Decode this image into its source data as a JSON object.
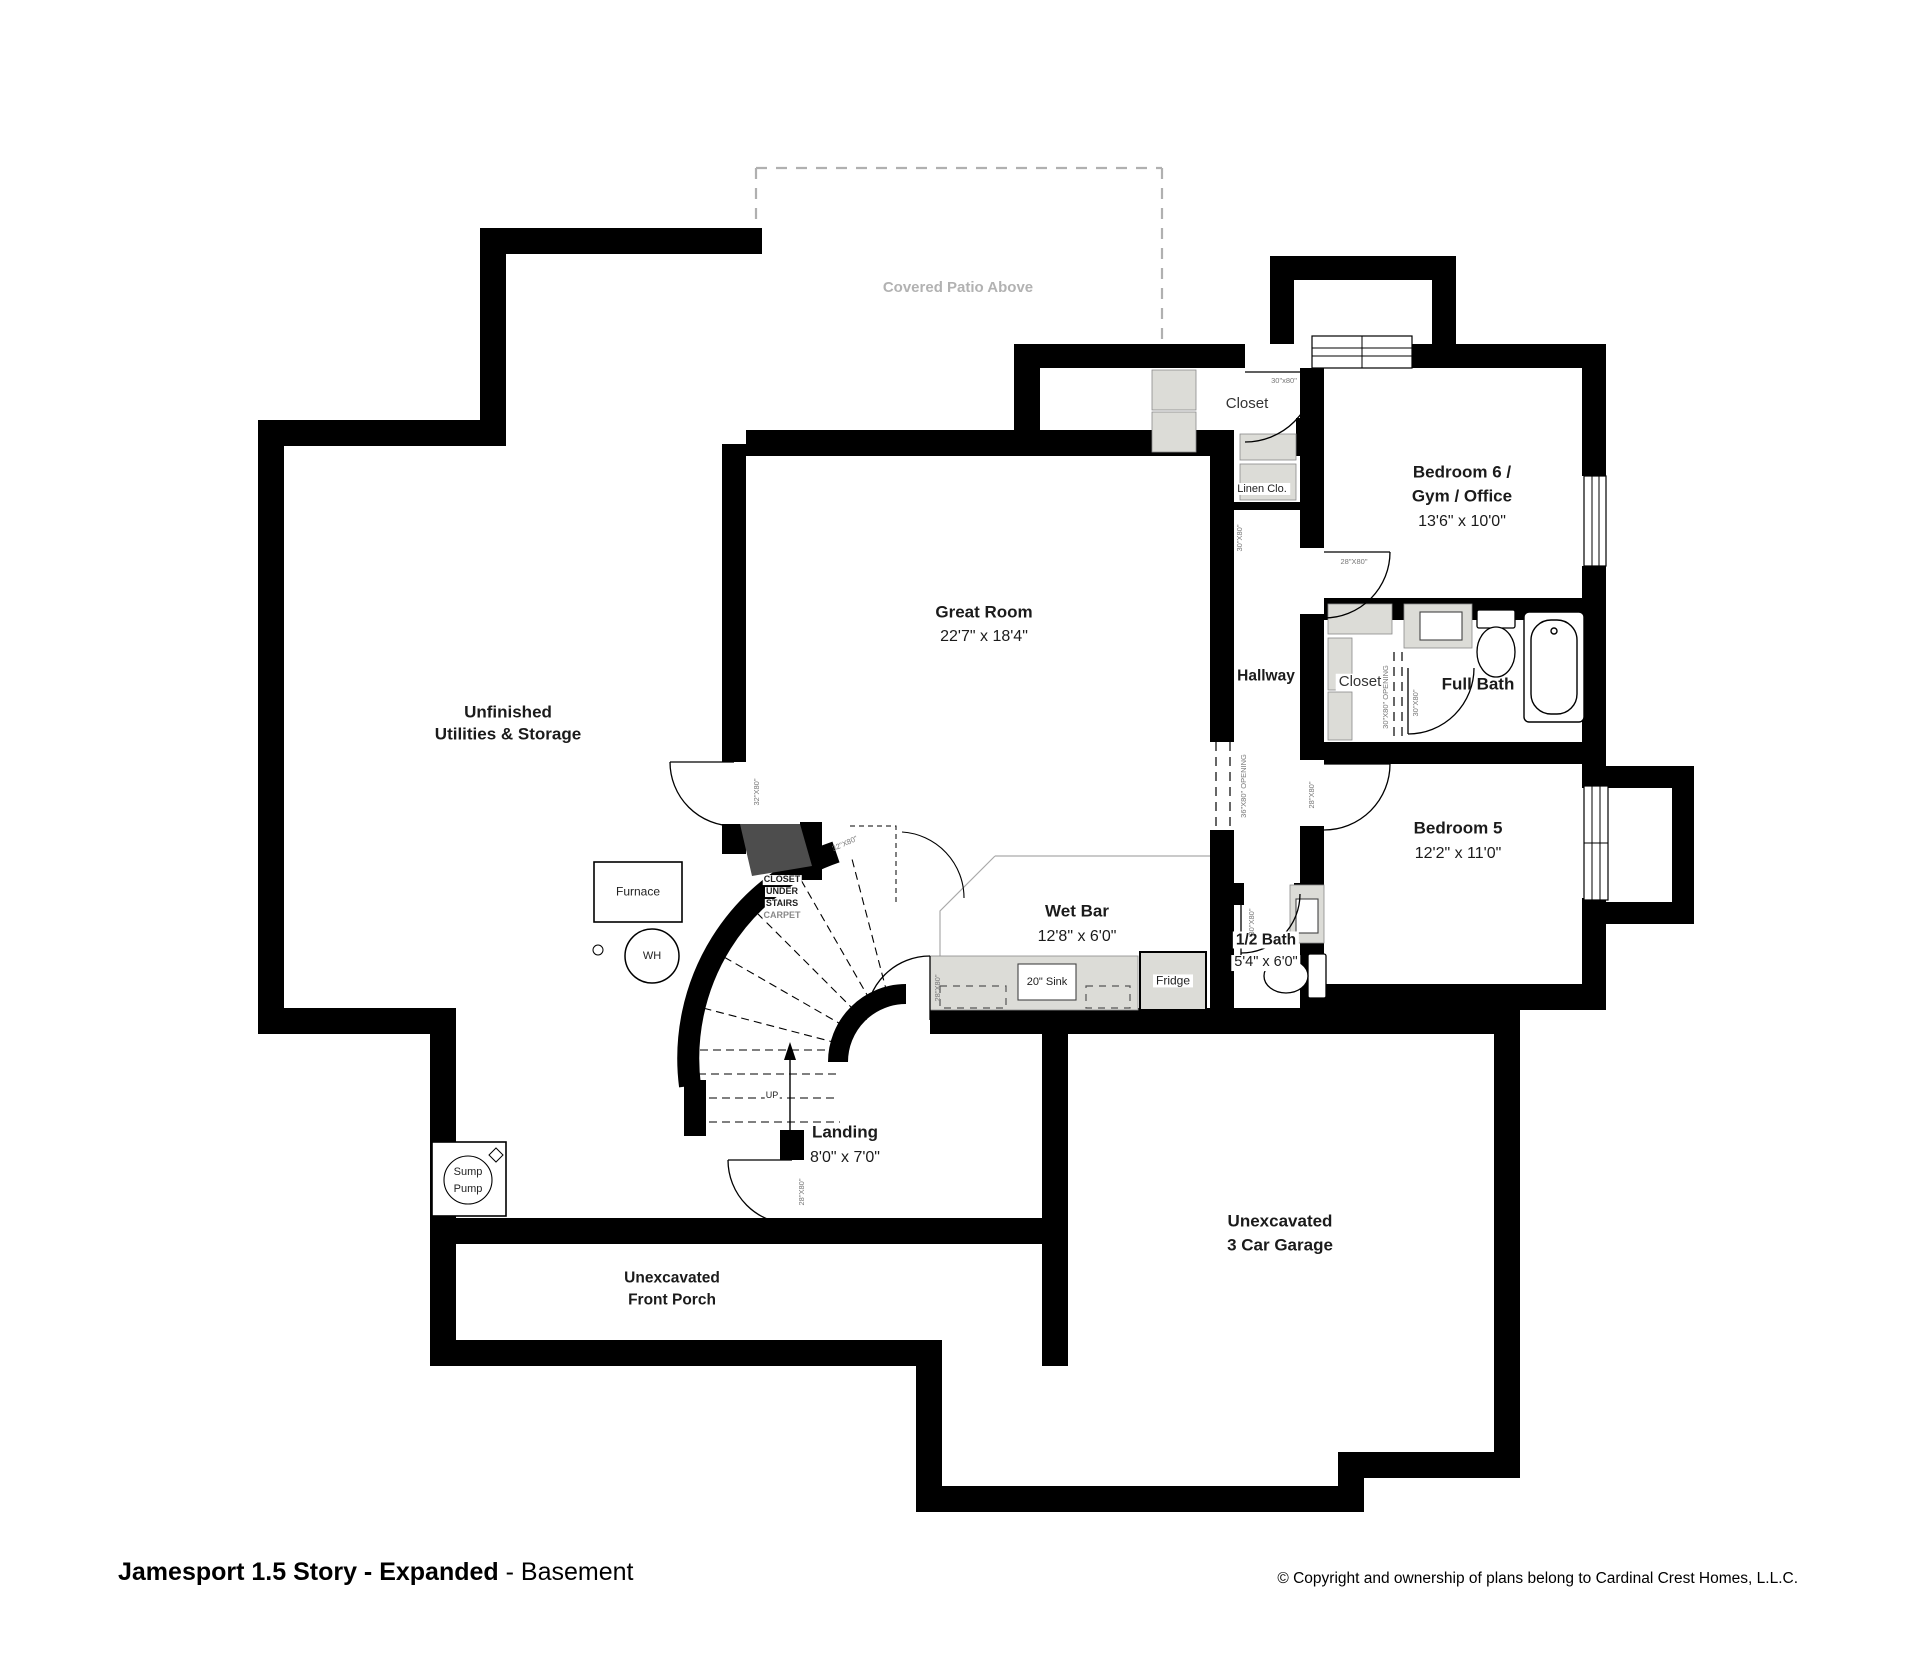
{
  "rooms": {
    "patio": {
      "name": "Covered Patio Above"
    },
    "unfinished": {
      "line1": "Unfinished",
      "line2": "Utilities & Storage"
    },
    "great_room": {
      "name": "Great Room",
      "dims": "22'7\" x 18'4\""
    },
    "closet_top": {
      "name": "Closet"
    },
    "linen": {
      "name": "Linen Clo."
    },
    "bedroom6": {
      "line1": "Bedroom 6 /",
      "line2": "Gym / Office",
      "dims": "13'6\" x 10'0\""
    },
    "hallway": {
      "name": "Hallway"
    },
    "closet_mid": {
      "name": "Closet"
    },
    "full_bath": {
      "name": "Full Bath"
    },
    "bedroom5": {
      "name": "Bedroom 5",
      "dims": "12'2\" x 11'0\""
    },
    "wet_bar": {
      "name": "Wet Bar",
      "dims": "12'8\" x 6'0\""
    },
    "half_bath": {
      "name": "1/2 Bath",
      "dims": "5'4\" x 6'0\""
    },
    "landing": {
      "name": "Landing",
      "dims": "8'0\" x 7'0\""
    },
    "garage": {
      "line1": "Unexcavated",
      "line2": "3 Car Garage"
    },
    "front_porch": {
      "line1": "Unexcavated",
      "line2": "Front Porch"
    }
  },
  "fixtures": {
    "furnace": "Furnace",
    "water_heater": "WH",
    "sump_line1": "Sump",
    "sump_line2": "Pump",
    "fridge": "Fridge",
    "sink": "20\" Sink"
  },
  "stairs": {
    "closet_line1": "CLOSET",
    "closet_line2": "UNDER",
    "closet_line3": "STAIRS",
    "closet_line4": "CARPET",
    "up": "UP"
  },
  "door_labels": {
    "d30": "30\"X80\"",
    "d30l": "30\"x80\"",
    "d32": "32\"X80\"",
    "d28": "28\"X80\"",
    "open36": "36\"X80\" OPENING",
    "open30": "30\"X80\" OPENING"
  },
  "footer": {
    "title_bold": "Jamesport 1.5 Story - Expanded",
    "title_rest": " - Basement",
    "copyright": "© Copyright and ownership of plans belong to Cardinal Crest Homes, L.L.C."
  },
  "colors": {
    "wall": "#000000",
    "counter_fill": "#dcdcd7",
    "patio_dash": "#b0b0b0",
    "stair_wedge": "#4d4d4d"
  }
}
